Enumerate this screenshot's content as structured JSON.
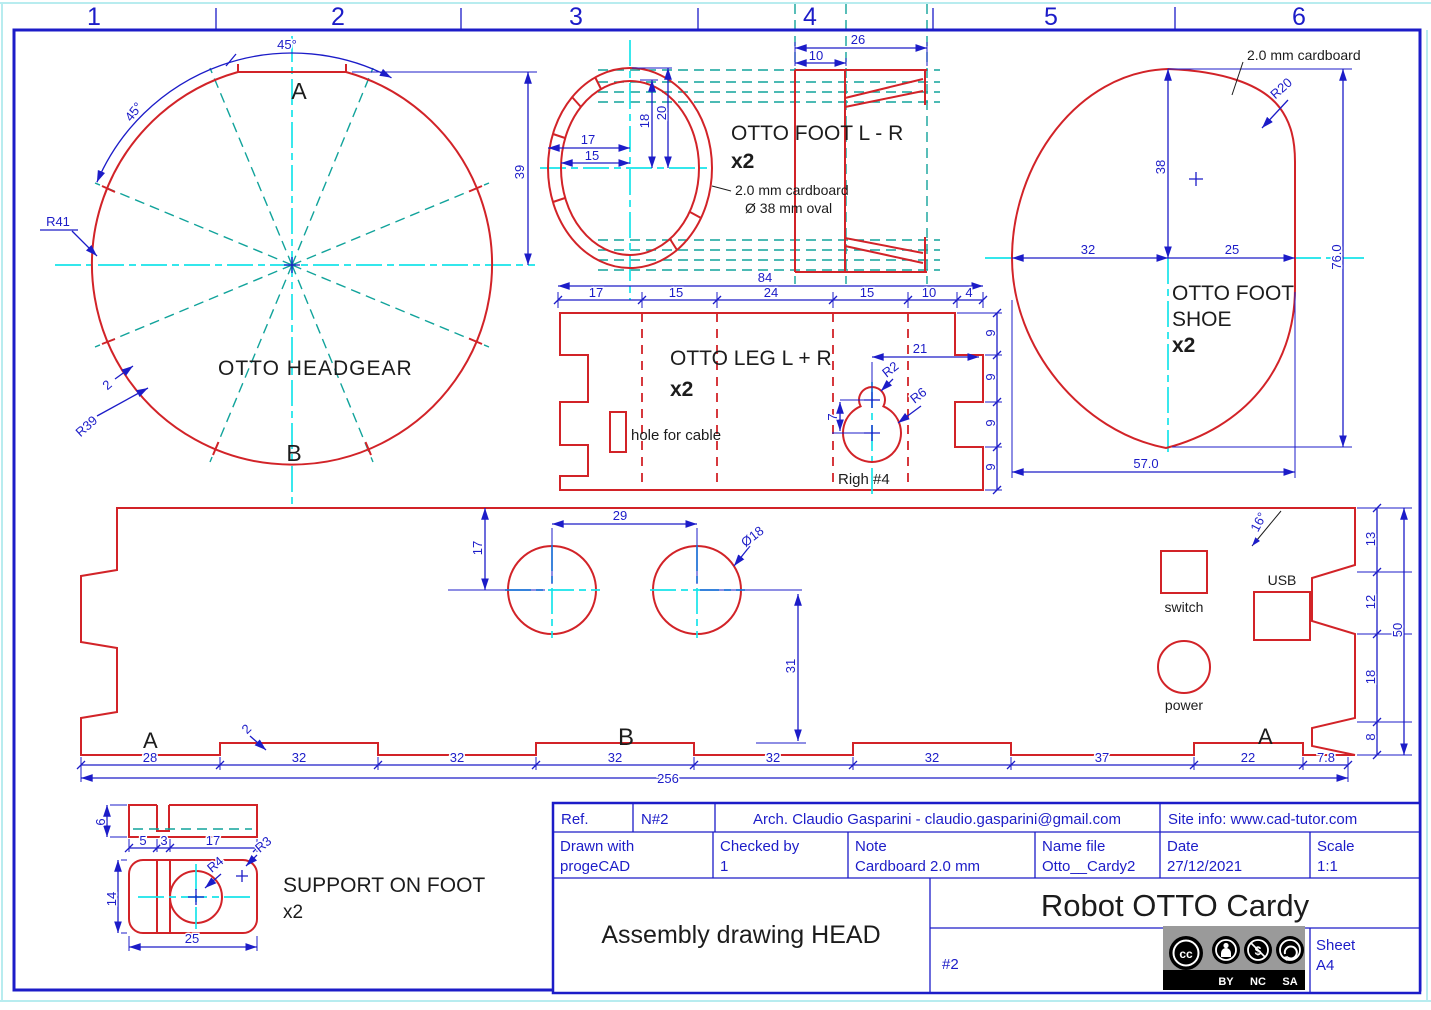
{
  "colors": {
    "dim_blue": "#1c1cc8",
    "outline_red": "#d22328",
    "part_yellow": "#f3ef4d",
    "centerline_cyan": "#17e4ea",
    "construction_teal": "#11a39b",
    "text_black": "#1c1c1c",
    "cc_gray": "#9a9a9a"
  },
  "ruler": {
    "n1": "1",
    "n2": "2",
    "n3": "3",
    "n4": "4",
    "n5": "5",
    "n6": "6"
  },
  "headgear": {
    "title": "OTTO HEADGEAR",
    "label_a": "A",
    "label_b": "B",
    "angle_top": "45°",
    "angle_side": "45°",
    "r41": "R41",
    "r39": "R39",
    "step": "2",
    "d39": "39"
  },
  "foot_lr": {
    "title": "OTTO FOOT L - R",
    "qty": "x2",
    "note_material": "2.0 mm cardboard",
    "note_oval": "Ø  38 mm oval",
    "d26": "26",
    "d10": "10",
    "d17": "17",
    "d15": "15",
    "d18": "18",
    "d20": "20"
  },
  "leg": {
    "title": "OTTO LEG L + R",
    "qty": "x2",
    "hole_note": "hole for cable",
    "righ_note": "Righ #4",
    "d84": "84",
    "seg17": "17",
    "seg15a": "15",
    "seg24": "24",
    "seg15b": "15",
    "seg10": "10",
    "seg4": "4",
    "d21": "21",
    "r2": "R2",
    "r6": "R6",
    "d7": "7",
    "d9a": "9",
    "d9b": "9",
    "d9c": "9",
    "d9d": "9"
  },
  "shoe": {
    "title_line1": "OTTO FOOT",
    "title_line2": "SHOE",
    "qty": "x2",
    "note_material": "2.0 mm cardboard",
    "r20": "R20",
    "d38": "38",
    "d32": "32",
    "d25": "25",
    "d76": "76.0",
    "d57": "57.0"
  },
  "band": {
    "label_a_left": "A",
    "label_b": "B",
    "label_a_right": "A",
    "switch_label": "switch",
    "usb_label": "USB",
    "power_label": "power",
    "d29": "29",
    "d17": "17",
    "dia18": "Ø18",
    "d31": "31",
    "a16": "16°",
    "step": "2",
    "r13": "13",
    "r12": "12",
    "r18": "18",
    "r8": "8",
    "r50": "50",
    "b28": "28",
    "b32a": "32",
    "b32b": "32",
    "b32c": "32",
    "b32d": "32",
    "b32e": "32",
    "b37": "37",
    "b22": "22",
    "b78": "7.8",
    "b256": "256"
  },
  "support": {
    "title": "SUPPORT ON FOOT",
    "qty": "x2",
    "d6": "6",
    "d5": "5",
    "d3": "3",
    "d17": "17",
    "d14": "14",
    "d25": "25",
    "r4": "R4",
    "r3": "R3"
  },
  "titleblock": {
    "ref_label": "Ref.",
    "ref_value": "N#2",
    "author": "Arch. Claudio Gasparini - claudio.gasparini@gmail.com",
    "site": "Site info: www.cad-tutor.com",
    "drawn_label": "Drawn with",
    "drawn_value": "progeCAD",
    "checked_label": "Checked by",
    "checked_value": "1",
    "note_label": "Note",
    "note_value": "Cardboard 2.0 mm",
    "file_label": "Name file",
    "file_value": "Otto__Cardy2",
    "date_label": "Date",
    "date_value": "27/12/2021",
    "scale_label": "Scale",
    "scale_value": "1:1",
    "drawing_title": "Assembly drawing HEAD",
    "project_title": "Robot OTTO Cardy",
    "sheet_number": "#2",
    "sheet_label": "Sheet",
    "sheet_value": "A4",
    "cc_mark": "cc",
    "cc_by": "BY",
    "cc_nc": "NC",
    "cc_sa": "SA"
  }
}
